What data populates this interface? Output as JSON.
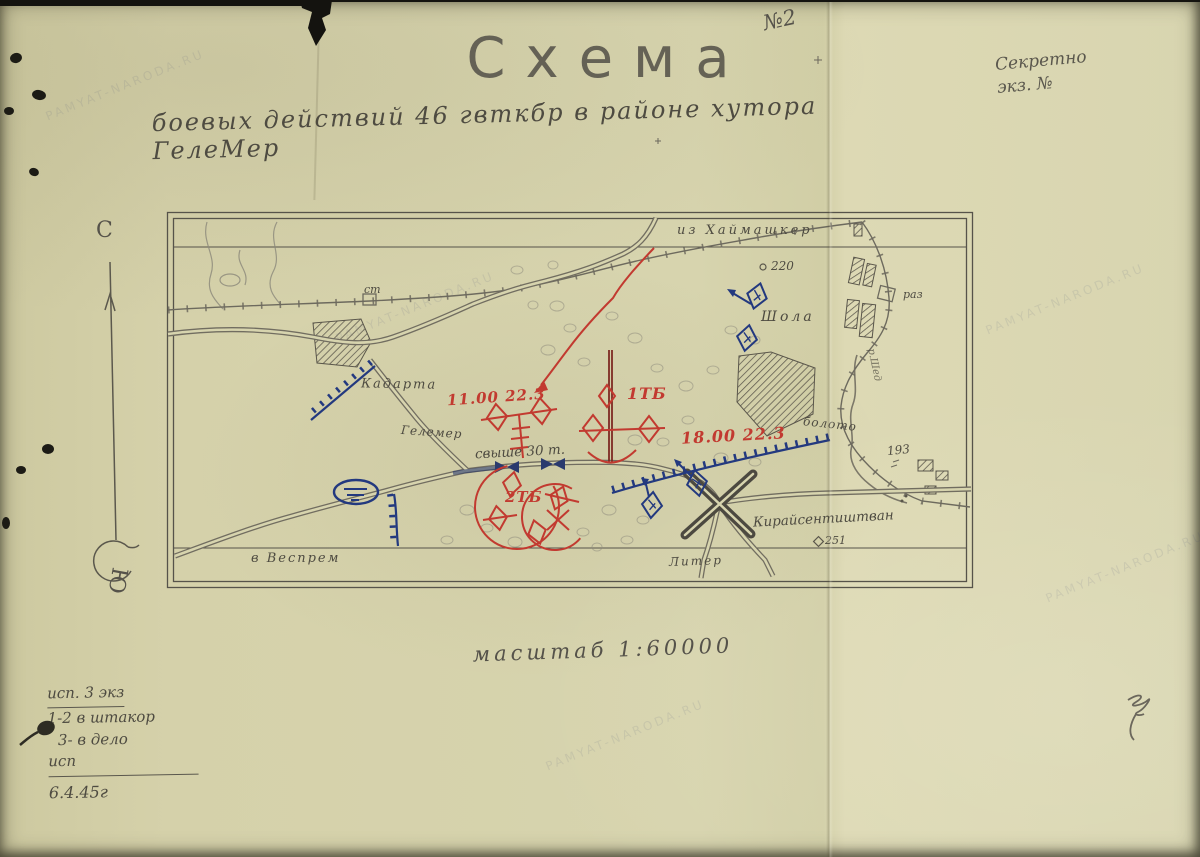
{
  "header": {
    "doc_number": "№2",
    "secrecy": {
      "line1": "Секретно",
      "line2": "экз. №"
    },
    "title": "Схема",
    "subtitle": "боевых действий 46 гвткбр в районе хутора ГелеМер"
  },
  "compass": {
    "north": "С",
    "south": "Ю"
  },
  "map": {
    "top_label": "из Хаймашкер",
    "labels": {
      "station": "ст",
      "kadarta": "Кадарта",
      "gelemer": "Гелемер",
      "bridge_capacity": "свыше 30 т.",
      "veszprem": "в Веспрем",
      "liter": "Литер",
      "kiraly": "Кирайсентиштван",
      "kiraly_height": "251",
      "shola": "Шола",
      "height220": "220",
      "raz": "раз",
      "boloto": "болото",
      "height193": "193",
      "river": "р.Шед"
    },
    "red_labels": {
      "time1": "11.00 22.3",
      "tb1": "1ТБ",
      "time2": "18.00 22.3",
      "tb2": "2ТБ"
    }
  },
  "scale_label": "масштаб 1:60000",
  "notes": {
    "line1": "исп. 3 экз",
    "line2": "1-2 в штакор",
    "line3": "3- в дело",
    "line4": "исп",
    "date": "6.4.45г"
  },
  "watermark": "PAMYAT-NARODA.RU",
  "colors": {
    "paper": "#d7d4ae",
    "pencil": "#4e4b41",
    "red": "#c23a30",
    "blue": "#23397f",
    "dark_red": "#7d2a22"
  }
}
